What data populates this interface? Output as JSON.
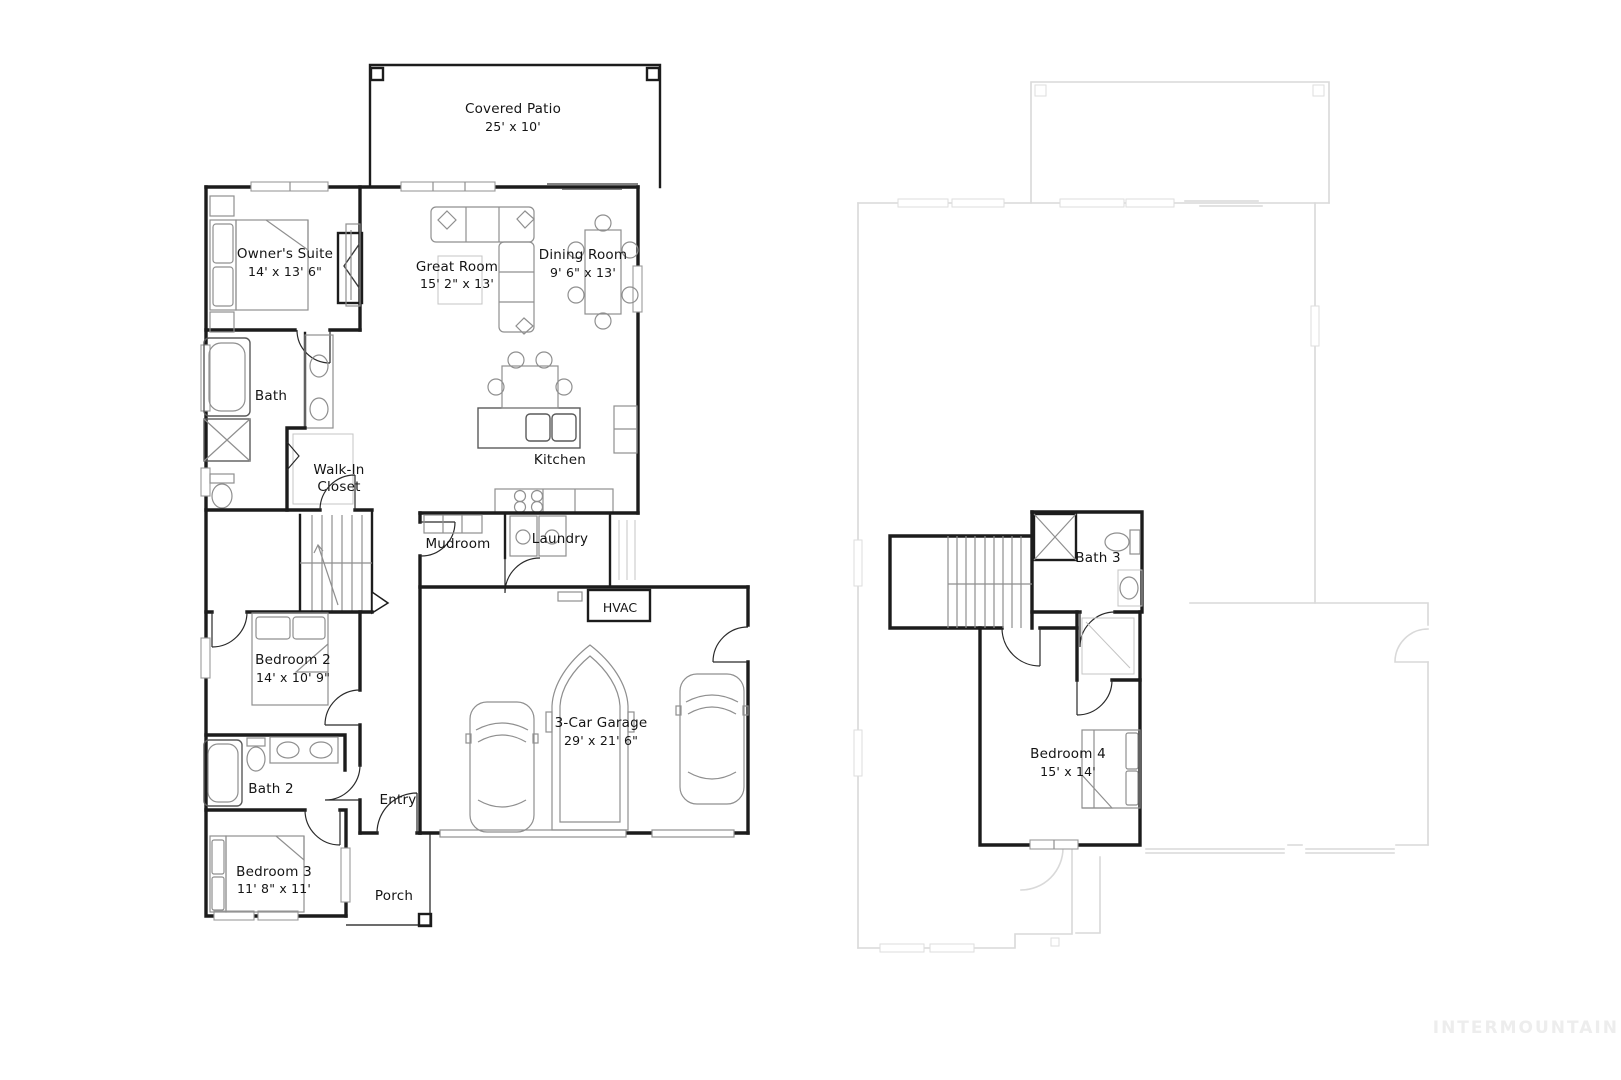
{
  "first_floor": {
    "covered_patio": {
      "name": "Covered Patio",
      "dims": "25' x 10'"
    },
    "owners_suite": {
      "name": "Owner's Suite",
      "dims": "14' x 13' 6\""
    },
    "great_room": {
      "name": "Great Room",
      "dims": "15' 2\" x 13'"
    },
    "dining_room": {
      "name": "Dining Room",
      "dims": "9' 6\" x 13'"
    },
    "bath": {
      "name": "Bath"
    },
    "walk_in_closet": {
      "line1": "Walk-In",
      "line2": "Closet"
    },
    "kitchen": {
      "name": "Kitchen"
    },
    "mudroom": {
      "name": "Mudroom"
    },
    "laundry": {
      "name": "Laundry"
    },
    "hvac": {
      "name": "HVAC"
    },
    "garage": {
      "name": "3-Car Garage",
      "dims": "29' x 21' 6\""
    },
    "bedroom2": {
      "name": "Bedroom 2",
      "dims": "14' x 10' 9\""
    },
    "bath2": {
      "name": "Bath 2"
    },
    "entry": {
      "name": "Entry"
    },
    "bedroom3": {
      "name": "Bedroom 3",
      "dims": "11' 8\" x 11'"
    },
    "porch": {
      "name": "Porch"
    }
  },
  "second_floor": {
    "bath3": {
      "name": "Bath 3"
    },
    "bedroom4": {
      "name": "Bedroom 4",
      "dims": "15' x 14'"
    }
  },
  "watermark": "INTERMOUNTAIN",
  "colors": {
    "wall": "#1c1c1c",
    "furniture": "#8f8f8f",
    "faint_outline": "#d9d9d9",
    "background": "#ffffff",
    "watermark": "#ededed"
  }
}
